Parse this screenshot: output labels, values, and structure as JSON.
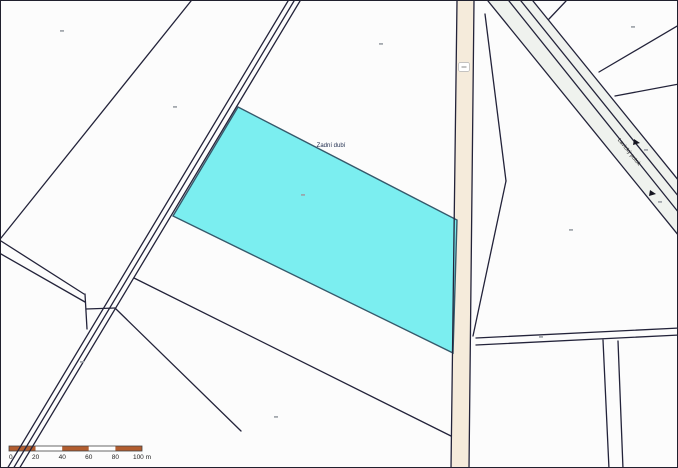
{
  "map": {
    "width": 678,
    "height": 468,
    "background": "#fcfcfc",
    "line_color": "#23233a",
    "labels": [
      {
        "name": "parcel-name-label",
        "text": "Zadní dubí",
        "x": 330,
        "y": 146,
        "size": 6,
        "color": "#233050",
        "rotate": 0
      },
      {
        "name": "stream-name-label",
        "text": "Lavický potok",
        "x": 627,
        "y": 152,
        "size": 5.5,
        "color": "#222222",
        "rotate": 51
      }
    ],
    "highlight_parcel": {
      "points": "237,106 456,219 452,352 172,215",
      "fill": "#7beef0",
      "stroke": "#35596b"
    },
    "road": {
      "polygon": "456,0 473,0 468,468 450,468",
      "fill": "#f5ebdb",
      "badge": {
        "x": 463,
        "y": 66,
        "w": 11,
        "h": 9
      }
    },
    "stream_band": {
      "points": "487,0 532,0 678,180 678,235",
      "fill": "#eff2ee"
    },
    "lines": [
      [
        190,
        0,
        0,
        237
      ],
      [
        287,
        0,
        6,
        468
      ],
      [
        293,
        0,
        12,
        468
      ],
      [
        299,
        0,
        18,
        468
      ],
      [
        0,
        240,
        83,
        293
      ],
      [
        0,
        253,
        84,
        301
      ],
      [
        84,
        293,
        86,
        328
      ],
      [
        85,
        308,
        114,
        307
      ],
      [
        133,
        277,
        450,
        435
      ],
      [
        115,
        308,
        240,
        430
      ],
      [
        456,
        0,
        450,
        468
      ],
      [
        473,
        0,
        468,
        468
      ],
      [
        484,
        13,
        505,
        180
      ],
      [
        505,
        180,
        472,
        335
      ],
      [
        475,
        337,
        678,
        327
      ],
      [
        475,
        344,
        678,
        334
      ],
      [
        602,
        339,
        608,
        468
      ],
      [
        617,
        340,
        622,
        468
      ],
      [
        487,
        0,
        678,
        235
      ],
      [
        508,
        0,
        678,
        212
      ],
      [
        520,
        0,
        678,
        196
      ],
      [
        532,
        0,
        678,
        180
      ],
      [
        565,
        0,
        548,
        18
      ],
      [
        678,
        24,
        598,
        71
      ],
      [
        678,
        83,
        614,
        95
      ]
    ],
    "flow_arrows": [
      [
        633,
        141
      ],
      [
        649,
        192
      ]
    ],
    "parcel_marks": [
      [
        59,
        29
      ],
      [
        378,
        42
      ],
      [
        630,
        25
      ],
      [
        172,
        105
      ],
      [
        300,
        193
      ],
      [
        568,
        228
      ],
      [
        538,
        335
      ],
      [
        79,
        360
      ],
      [
        273,
        415
      ],
      [
        643,
        148
      ],
      [
        657,
        200
      ]
    ],
    "scale_bar": {
      "x": 8,
      "y": 445,
      "height": 5,
      "segment_px": 26.6,
      "segments": 5,
      "color_a": "#b25d2f",
      "color_b": "#ffffff",
      "outline": "#444444",
      "tick_labels": [
        "0",
        "20",
        "40",
        "60",
        "80",
        "100 m"
      ],
      "label_color": "#222222",
      "label_size": 6.5
    }
  }
}
